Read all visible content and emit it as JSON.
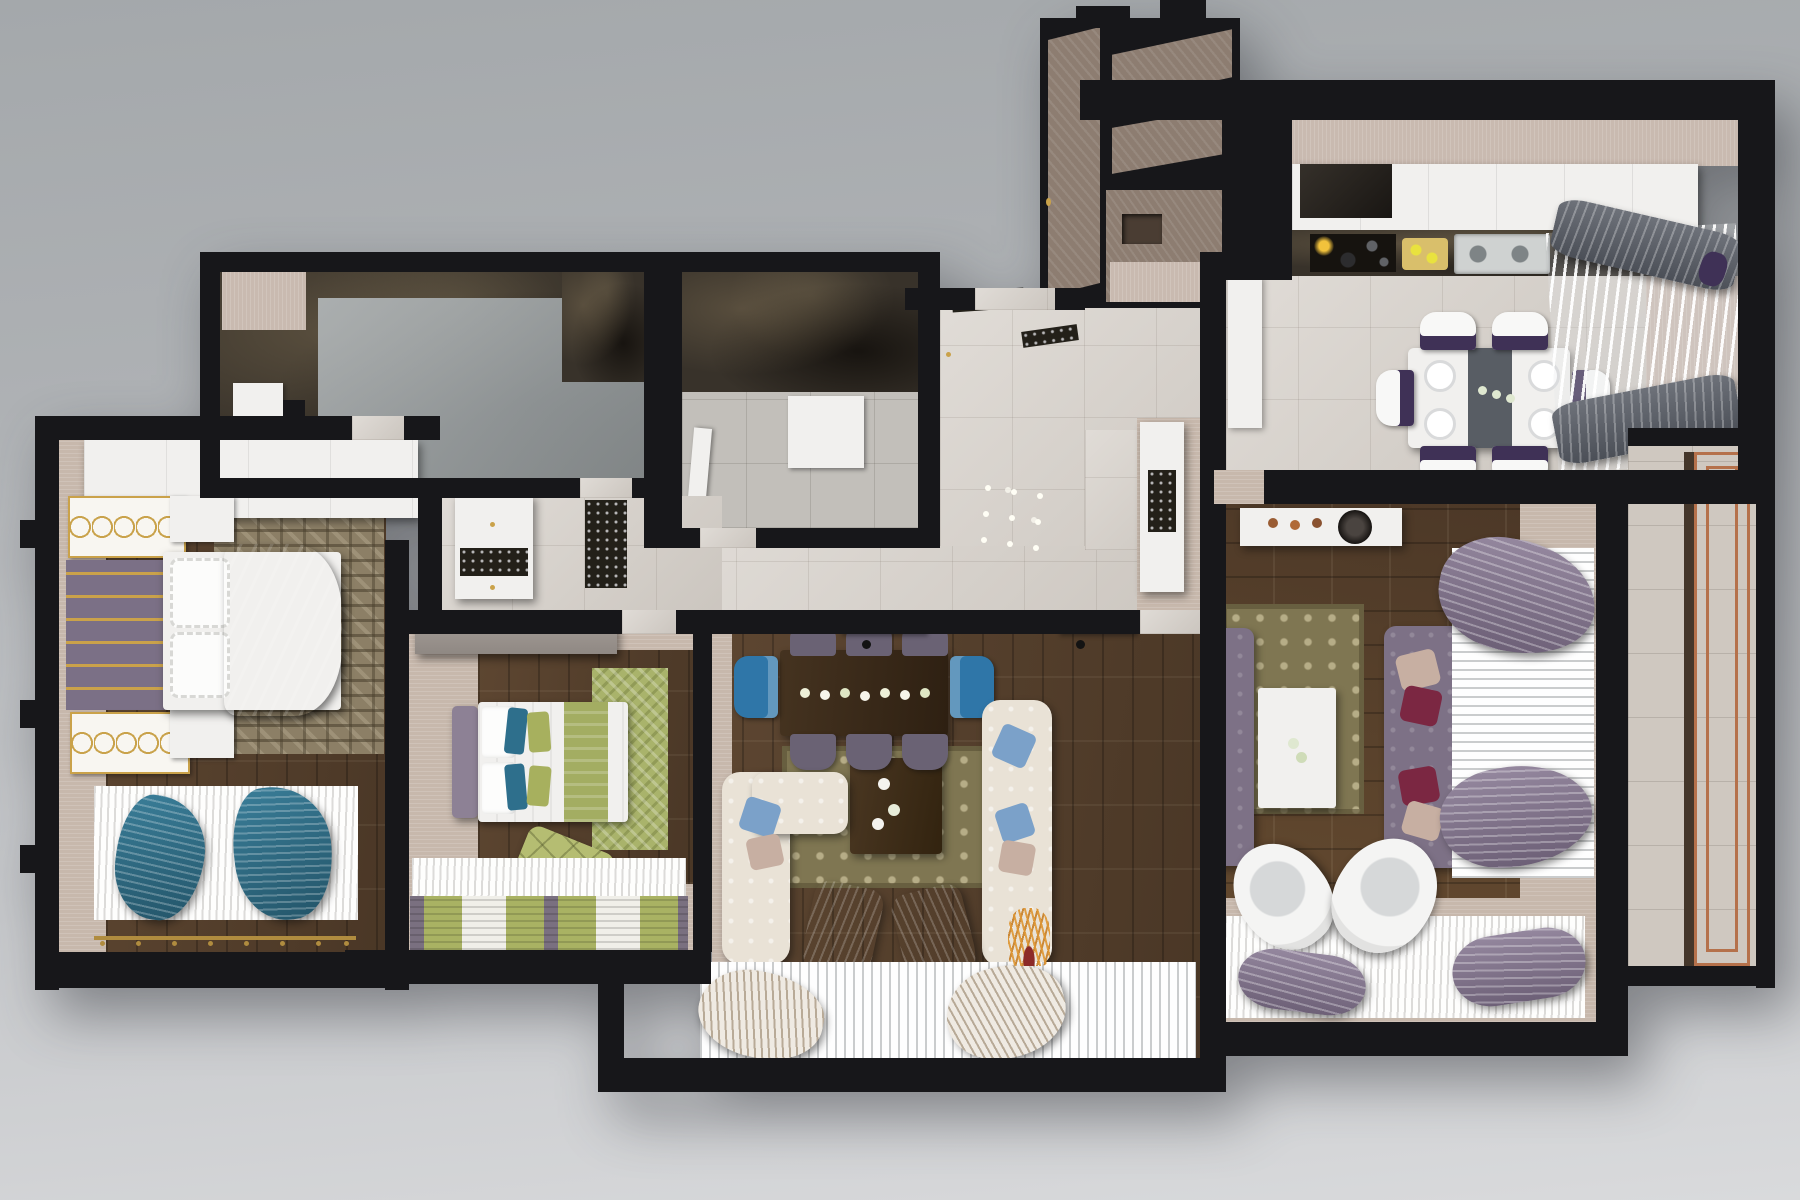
{
  "scene": {
    "title": "3D rendered top-down floor plan of a three-bedroom apartment",
    "view": "bird's-eye cutaway render, no visible text"
  },
  "palette": {
    "background_top": "#a4a8ab",
    "background_bottom": "#d9dadc",
    "exterior_walls": "#17171a",
    "wall_caps": "#c7b8ac",
    "wood_floor": "#55402d",
    "light_tile": "#d6d0c9",
    "dark_marble": "#38322a",
    "accent_gold": "#c9a24a",
    "sofa_purple": "#7d7186",
    "pillow_maroon": "#7b2742",
    "pillow_blush": "#c7afa2",
    "armchair_blue": "#2e7fb3",
    "bed_green": "#a3ad62",
    "teal_throw": "#2f6d86",
    "copper_rail": "#b5714b",
    "dining_seat_purple": "#3f3156"
  },
  "rooms": [
    {
      "id": "master-bedroom",
      "name": "Master bedroom",
      "floor": "dark wood parquet",
      "furniture": [
        "white wardrobe run",
        "gold ornament wall panels",
        "purple tufted headboard wall with gold rails",
        "double bed with white ruffled pillows",
        "purple duvet",
        "geometric taupe rug",
        "white nightstands",
        "white pleated window sheer",
        "two teal draped throws",
        "gold curtain rod"
      ]
    },
    {
      "id": "bedroom-2",
      "name": "Second bedroom",
      "floor": "dark wood parquet",
      "furniture": [
        "gray wardrobe",
        "purple headboard",
        "bed with white linen and green runner",
        "teal and green pillows",
        "green herringbone rug",
        "green quilted pouf",
        "green and white striped window curtain"
      ]
    },
    {
      "id": "bathroom",
      "name": "Bathroom",
      "floor": "dark marble tile",
      "furniture": [
        "glass shower screen",
        "white tub deck"
      ]
    },
    {
      "id": "shower-room",
      "name": "Shower room",
      "floor": "marble and gray tile",
      "furniture": [
        "white shower tray",
        "white door leaf"
      ]
    },
    {
      "id": "hallway",
      "name": "Hallway",
      "floor": "light beige tile",
      "furniture": [
        "white hall cabinet with mosaic inlay",
        "ornamental runner mat",
        "recessed ceiling spotlights",
        "white display cabinet"
      ]
    },
    {
      "id": "entry",
      "name": "Entry vestibule",
      "floor": "wood panel",
      "furniture": [
        "stepped entry walls",
        "wood wall fins",
        "recessed ceiling niche",
        "gold door handle"
      ]
    },
    {
      "id": "kitchen-dining",
      "name": "Kitchen and dining room",
      "floor": "light gray tile",
      "furniture": [
        "white upper cabinet run",
        "extractor hood",
        "gas hob with pots",
        "cutting board with lemons",
        "double sink",
        "dark marble counter",
        "white dining table with gray runner",
        "six white chairs with purple seats",
        "dinner plates",
        "flower vases",
        "fanned white sheer with gray drapes"
      ]
    },
    {
      "id": "living-room",
      "name": "Living room",
      "floor": "dark wood parquet",
      "furniture": [
        "wall shelves",
        "dark wood dining table with candle row",
        "six purple side chairs",
        "two blue end chairs",
        "patterned olive rug",
        "dark wood coffee table with white flowers",
        "cream tufted sectional sofa",
        "blue and blush pillows",
        "two blue slipper chairs",
        "dried gold plant",
        "white pleated window sheer",
        "two cream fan drapes"
      ]
    },
    {
      "id": "family-room",
      "name": "Family sitting room",
      "floor": "dark wood parquet",
      "furniture": [
        "white media console with copper decor",
        "two purple chesterfield sofas",
        "maroon and blush pillows",
        "patterned olive rug",
        "white coffee table with flowers",
        "two white swivel egg chairs",
        "white pleated window sheer",
        "purple swag drapes",
        "white fur rug"
      ]
    },
    {
      "id": "balcony",
      "name": "Balcony",
      "floor": "pale tile",
      "furniture": [
        "copper railing frames",
        "dark timber edge strip"
      ]
    }
  ]
}
